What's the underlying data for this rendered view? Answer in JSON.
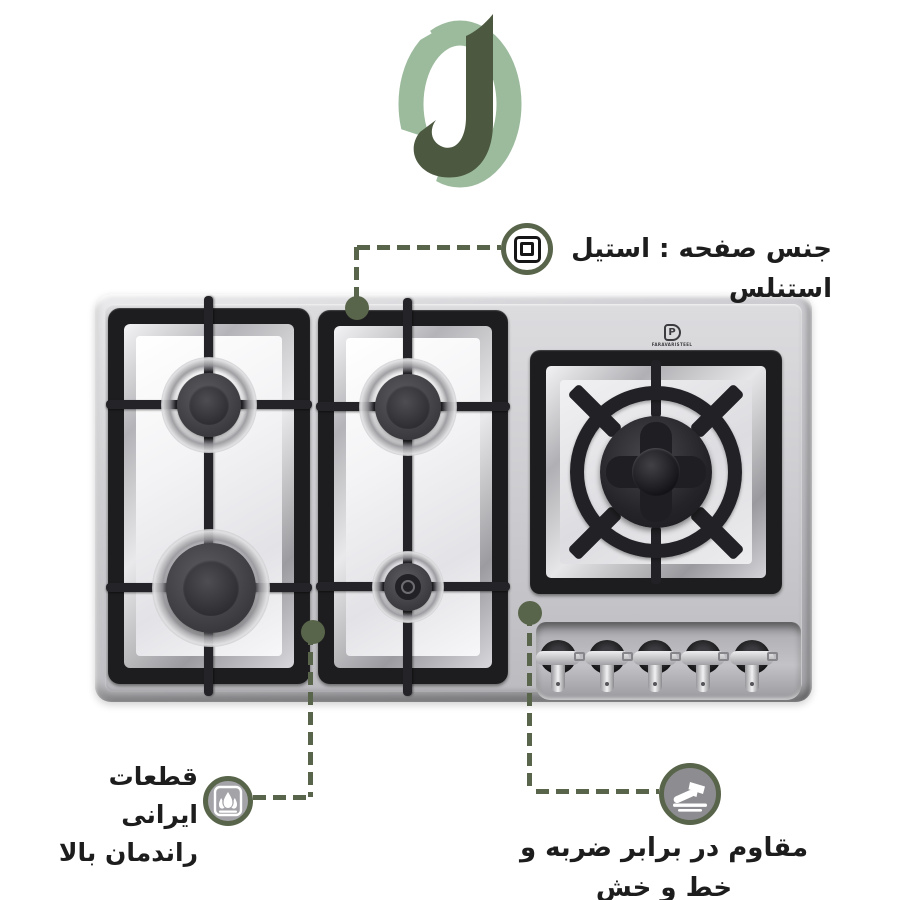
{
  "page": {
    "background": "#ffffff"
  },
  "logo": {
    "name": "letter-j-brand-logo",
    "dark_green": "#4c5940",
    "light_green": "#9cbb9d"
  },
  "callouts": {
    "accent_color": "#59654a",
    "surface": {
      "icon": "stainless-surface-icon",
      "text": "جنس صفحه : استیل استنلس"
    },
    "parts": {
      "icon": "flame-icon",
      "line1": "قطعات ایرانی",
      "line2": "راندمان بالا"
    },
    "durability": {
      "icon": "hammer-icon",
      "text": "مقاوم در برابر ضربه و خط و خش"
    }
  },
  "stove": {
    "brand_mark": "P",
    "brand_text": "FARAVARISTEEL",
    "burner_count": 5,
    "knob_count": 5,
    "material_colors": {
      "steel": "#c6c6ca",
      "cast_iron": "#1e1e22"
    }
  }
}
